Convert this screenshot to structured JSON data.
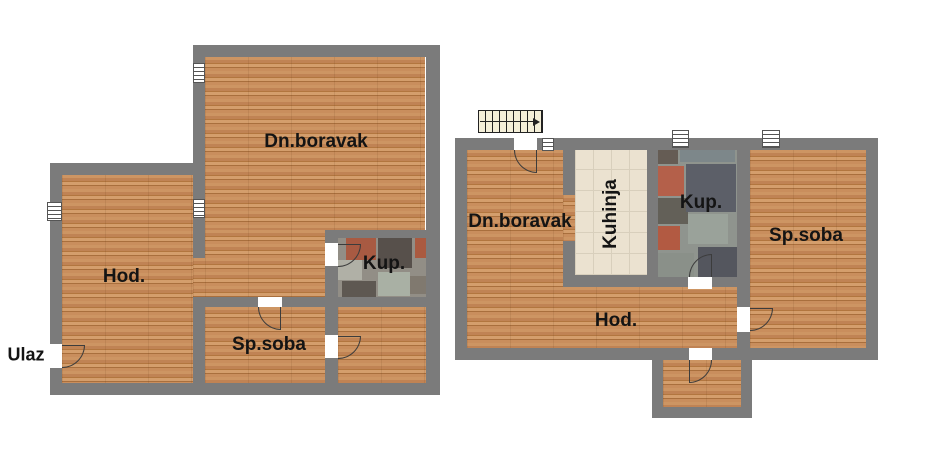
{
  "canvas": {
    "width": 925,
    "height": 468,
    "background": "#ffffff"
  },
  "palette": {
    "wall": "#7b7b7b",
    "wood_floor": "#c38a57",
    "kitchen_tile": "#ebe2d0",
    "bath_tile_base": "#8f948e",
    "bath_tile_red": "#a85a42",
    "bath_tile_dark": "#57504b",
    "door_line": "#3c3c3c",
    "label_color": "#141414"
  },
  "symbols": {
    "stairs": "stairs-symbol",
    "window": "window-symbol",
    "radiator": "radiator-symbol",
    "door": "door-swing-symbol"
  },
  "apartments": [
    {
      "name": "left-unit",
      "labels": {
        "living": "Dn.boravak",
        "hallway": "Hod.",
        "bathroom": "Kup.",
        "bedroom": "Sp.soba",
        "entrance": "Ulaz"
      }
    },
    {
      "name": "right-unit",
      "labels": {
        "living": "Dn.boravak",
        "kitchen": "Kuhinja",
        "bathroom": "Kup.",
        "bedroom": "Sp.soba",
        "hallway": "Hod."
      }
    }
  ]
}
